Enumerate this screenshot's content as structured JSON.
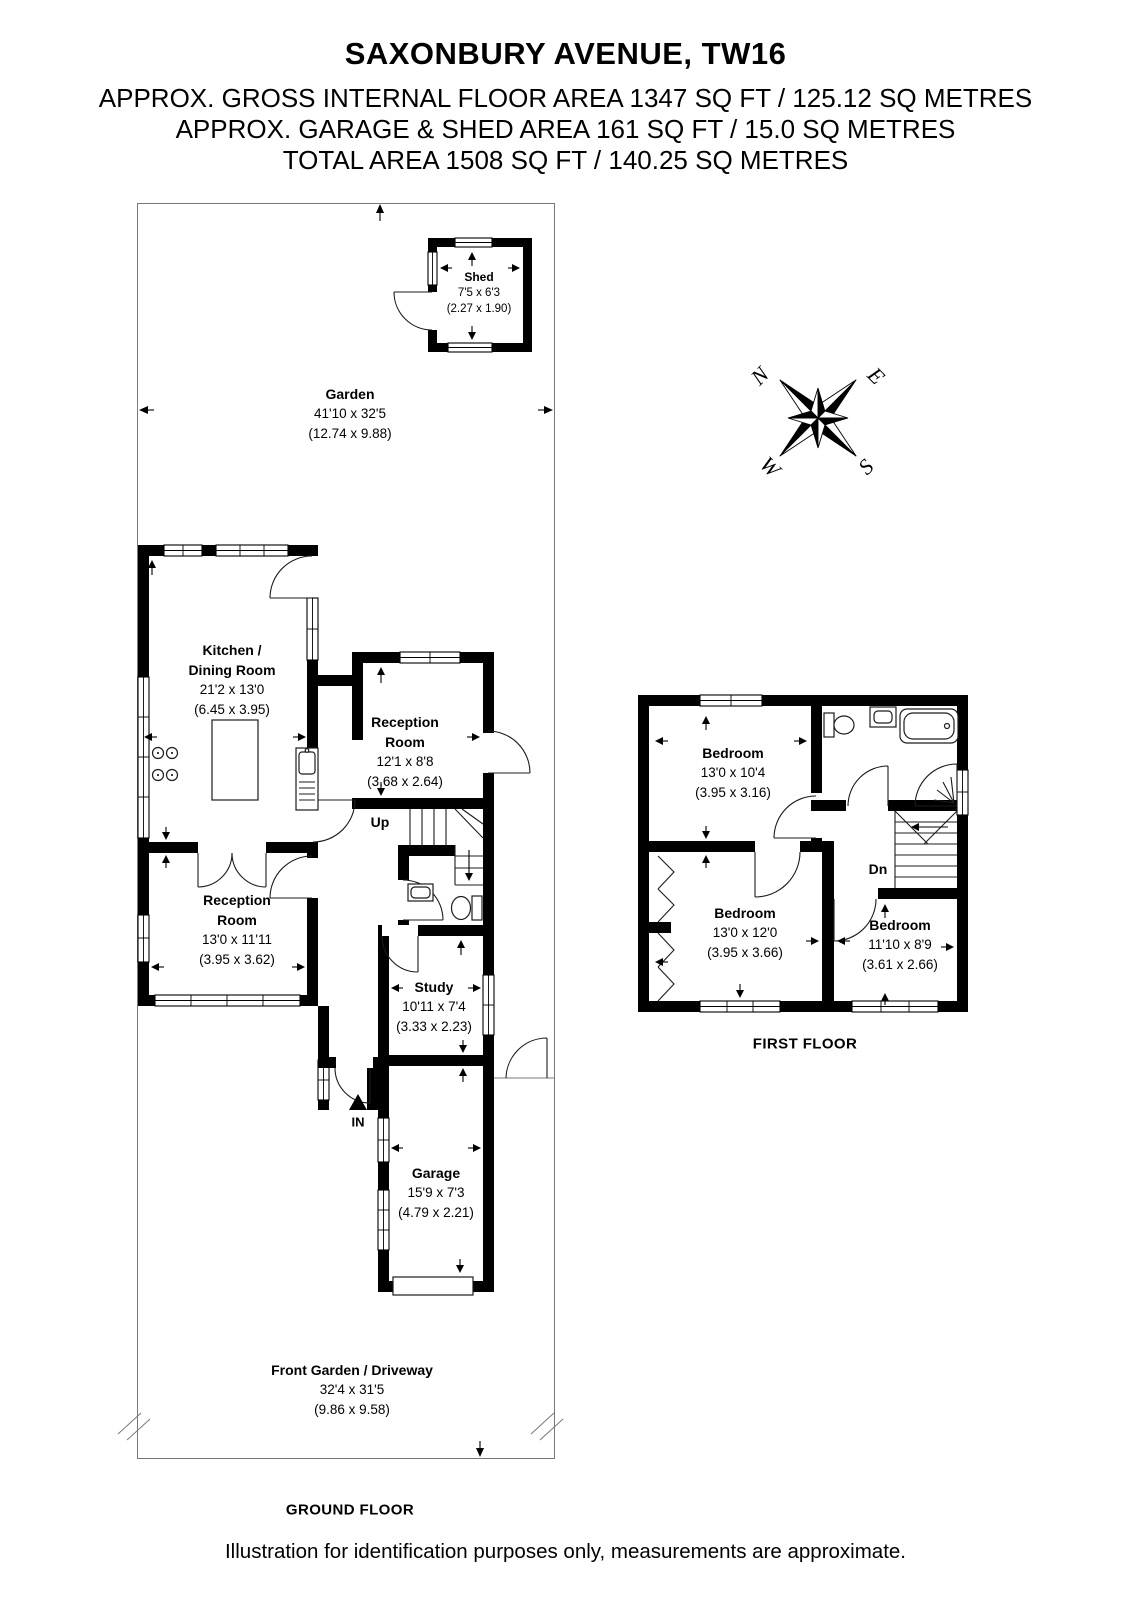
{
  "header": {
    "title": "SAXONBURY AVENUE, TW16",
    "area_line1": "APPROX. GROSS INTERNAL FLOOR AREA 1347 SQ FT / 125.12 SQ METRES",
    "area_line2": "APPROX. GARAGE & SHED AREA 161 SQ FT / 15.0 SQ METRES",
    "area_line3": "TOTAL AREA 1508 SQ FT / 140.25 SQ METRES"
  },
  "compass": {
    "n": "N",
    "e": "E",
    "s": "S",
    "w": "W"
  },
  "ground_floor": {
    "caption": "GROUND FLOOR",
    "rooms": {
      "shed": {
        "name": "Shed",
        "dims_ft": "7'5 x 6'3",
        "dims_m": "(2.27 x 1.90)"
      },
      "garden": {
        "name": "Garden",
        "dims_ft": "41'10 x 32'5",
        "dims_m": "(12.74 x 9.88)"
      },
      "kitchen_dining": {
        "name": "Kitchen / Dining Room",
        "dims_ft": "21'2 x 13'0",
        "dims_m": "(6.45 x 3.95)"
      },
      "reception_1": {
        "name": "Reception Room",
        "dims_ft": "12'1 x 8'8",
        "dims_m": "(3.68 x 2.64)"
      },
      "reception_2": {
        "name": "Reception Room",
        "dims_ft": "13'0 x 11'11",
        "dims_m": "(3.95 x 3.62)"
      },
      "study": {
        "name": "Study",
        "dims_ft": "10'11 x 7'4",
        "dims_m": "(3.33 x 2.23)"
      },
      "garage": {
        "name": "Garage",
        "dims_ft": "15'9 x 7'3",
        "dims_m": "(4.79 x 2.21)"
      },
      "front_garden": {
        "name": "Front Garden / Driveway",
        "dims_ft": "32'4 x 31'5",
        "dims_m": "(9.86 x 9.58)"
      }
    },
    "labels": {
      "up": "Up",
      "entrance": "IN"
    }
  },
  "first_floor": {
    "caption": "FIRST FLOOR",
    "rooms": {
      "bedroom_1": {
        "name": "Bedroom",
        "dims_ft": "13'0 x 10'4",
        "dims_m": "(3.95 x 3.16)"
      },
      "bedroom_2": {
        "name": "Bedroom",
        "dims_ft": "13'0 x 12'0",
        "dims_m": "(3.95 x 3.66)"
      },
      "bedroom_3": {
        "name": "Bedroom",
        "dims_ft": "11'10 x 8'9",
        "dims_m": "(3.61 x 2.66)"
      }
    },
    "labels": {
      "down": "Dn"
    }
  },
  "footer": {
    "disclaimer": "Illustration for identification purposes only, measurements are approximate."
  },
  "colors": {
    "wall": "#000000",
    "background": "#ffffff",
    "boundary_line": "#787878"
  }
}
